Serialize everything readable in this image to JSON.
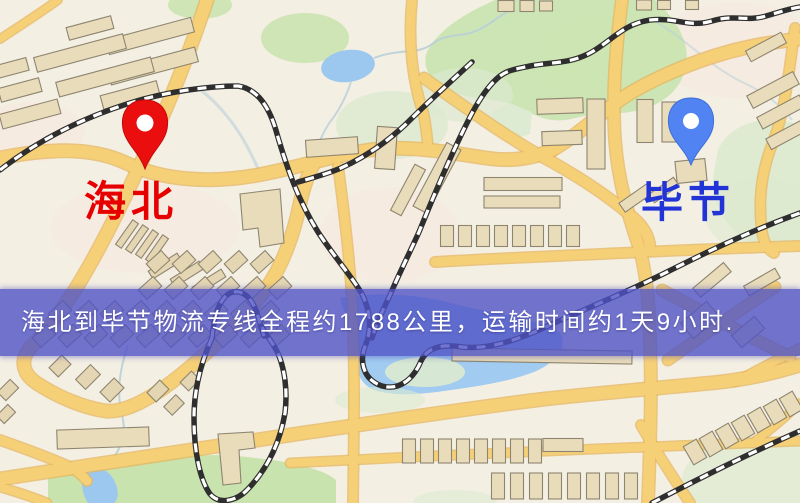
{
  "map": {
    "origin": {
      "label": "海北",
      "label_style": "color:#e60000",
      "pin_color": "#ea0e0e",
      "pin_name": "red-location-pin"
    },
    "destination": {
      "label": "毕节",
      "label_style": "color:#2334d6",
      "pin_color": "#5183f2",
      "pin_name": "blue-location-pin"
    }
  },
  "banner": {
    "text": "海北到毕节物流专线全程约1788公里，运输时间约1天9小时.",
    "style": "background:rgba(79,82,197,0.80)",
    "text_style": "color:#ffffff"
  },
  "route": {
    "origin": "海北",
    "destination": "毕节",
    "distance": "约1788公里",
    "duration": "约1天9小时"
  },
  "colors": {
    "map_background": "#f3efe3",
    "road_core": "#f6d077",
    "road_casing": "#e5b55c",
    "water": "#9cc8f0",
    "stream": "#b9cfd8",
    "park_strong": "#c9e3ae",
    "park_pale": "#dcead0",
    "pink_patch": "#f7e8e0",
    "building_fill": "#e9dcba",
    "building_fill_alt": "#e4d6b2",
    "building_stroke": "#8e8570",
    "railway_dark": "#2e2e2e",
    "railway_light": "#ffffff"
  }
}
